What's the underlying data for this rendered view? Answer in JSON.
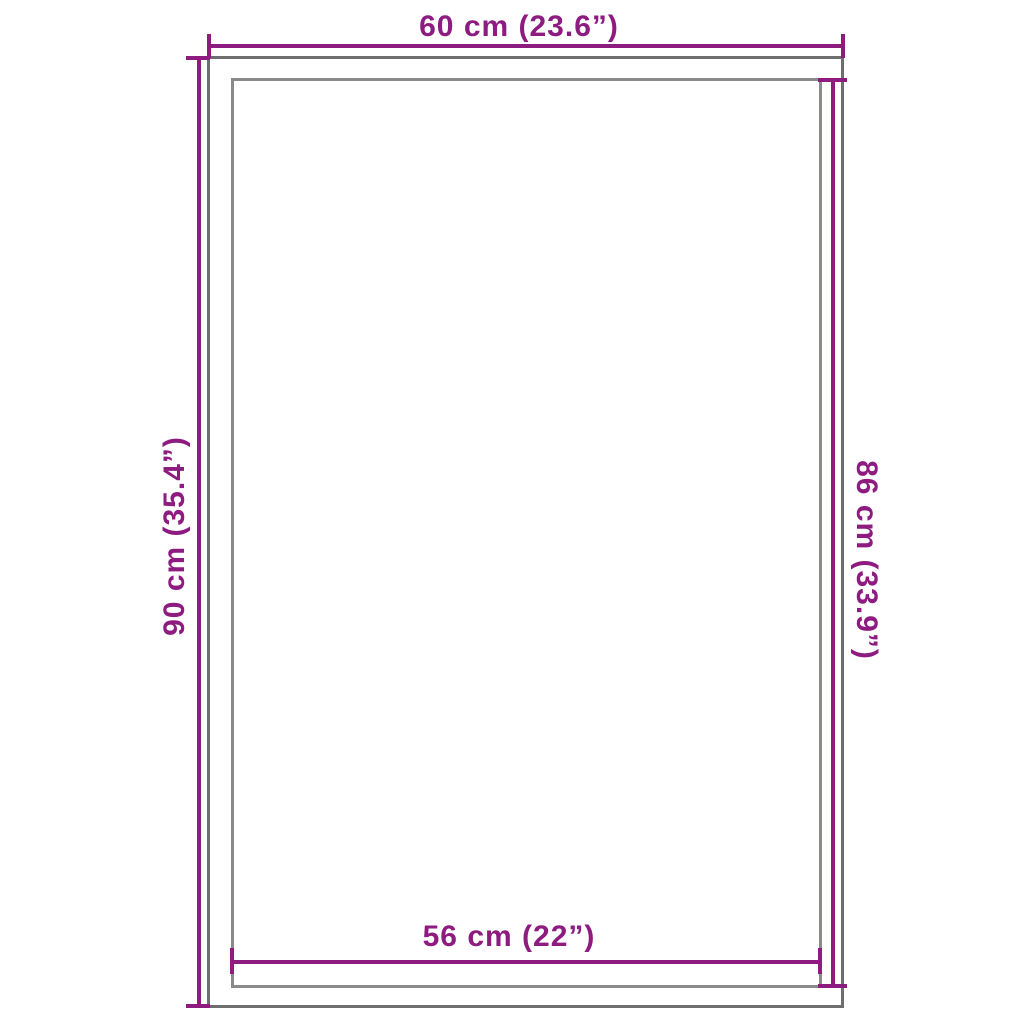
{
  "diagram": {
    "type": "product-dimension-diagram",
    "colors": {
      "background": "#FFFFFF",
      "accent": "#8D1B80",
      "outer_outline": "#6E6E6E",
      "inner_outline": "#8A8A8A"
    },
    "labels": {
      "top": "60 cm (23.6”)",
      "left": "90 cm (35.4”)",
      "right": "86 cm (33.9”)",
      "bottom": "56 cm (22”)"
    }
  }
}
